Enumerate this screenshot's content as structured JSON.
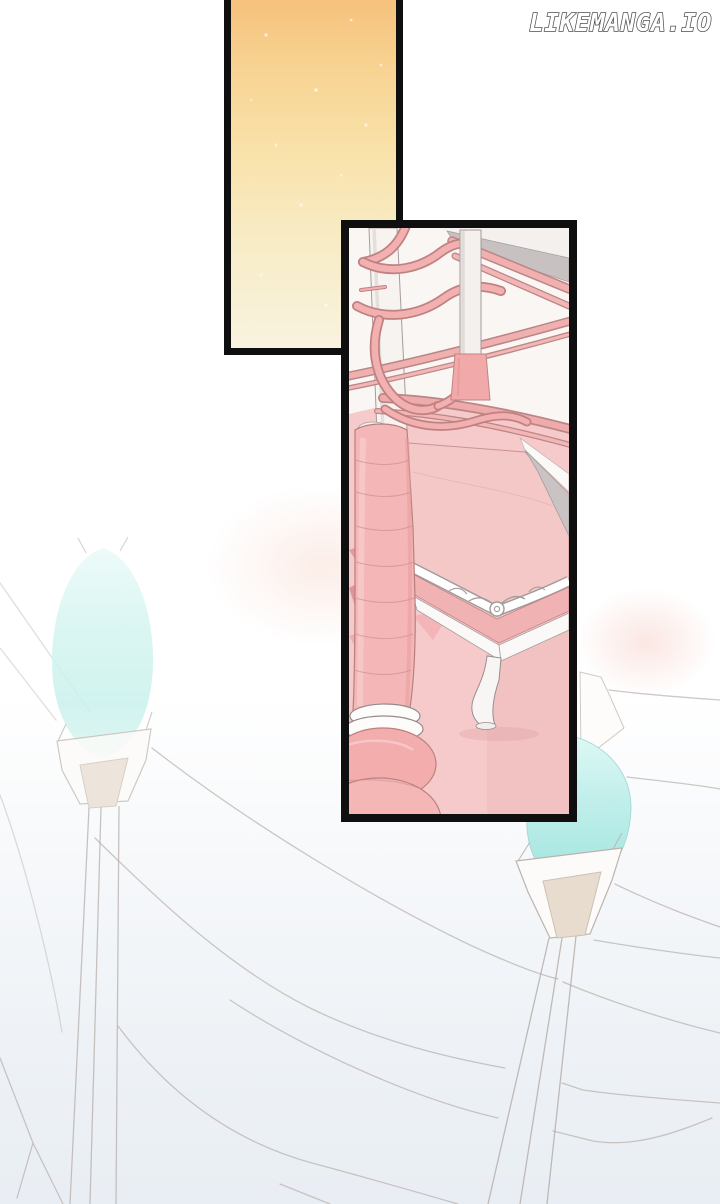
{
  "watermark": {
    "text": "LIKEMANGA.IO"
  },
  "palette": {
    "panel_border": "#0f0f0f",
    "sky_gradient_top": "#f6c07a",
    "sky_gradient_mid": "#f9e2ab",
    "sky_gradient_bottom": "#f8f3e0",
    "furniture_pink": "#f4b6b6",
    "furniture_pink_light": "#f5c8c8",
    "floor_checker_deep": "#e58f97",
    "gem_cyan": "#abe8e3",
    "sketch_line_grey": "#b4aba7",
    "background_bottom_tint": "#e9eef4",
    "watermark_fill": "#ffffff",
    "watermark_outline": "#4d4d4d"
  }
}
